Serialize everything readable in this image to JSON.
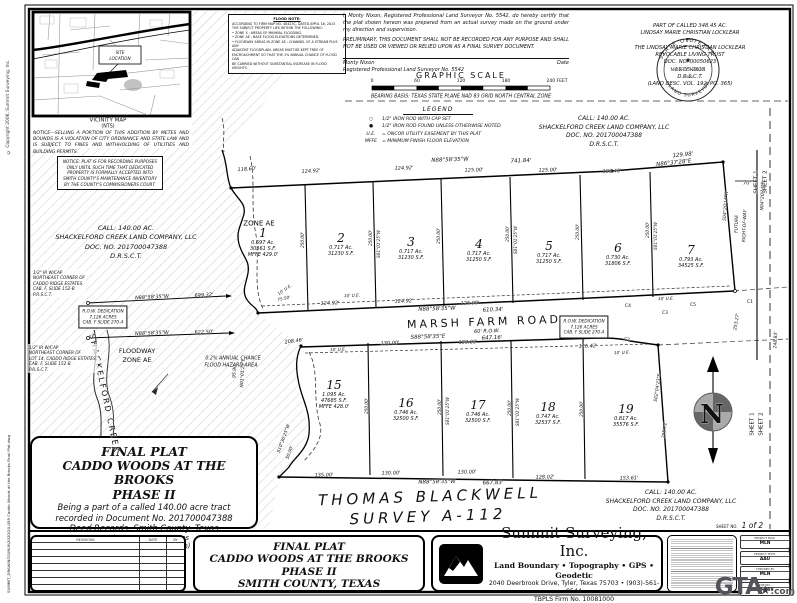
{
  "edge": {
    "copyright": "© Copyright 2006, Summit Surveying, Inc.",
    "file": "SUMMIT_DRAWINGS\\MLN\\2020\\20-059 Caddo Woods at the Brooks Final Plat.dwg"
  },
  "notices": {
    "selling": "NOTICE—SELLING A PORTION OF THIS ADDITION BY METES AND BOUNDS IS A VIOLATION OF CITY ORDINANCE AND STATE LAW AND IS SUBJECT TO FINES AND WITHHOLDING OF UTILITIES AND BUILDING PERMITS.",
    "recording": "NOTICE: PLAT IS FOR RECORDING PURPOSES ONLY UNTIL SUCH TIME THAT DEDICATED PROPERTY IS FORMALLY ACCEPTED INTO SMITH COUNTY'S MAINTENANCE INVENTORY BY THE COUNTY'S COMMISSIONERS COURT."
  },
  "flood_note": {
    "title": "FLOOD NOTE:",
    "lines": [
      "ACCORDING TO FIRM MAP NO. 48423C, DATED APRIL 16, 2013",
      "THE SUBJECT PROPERTY LIES WITHIN THE FOLLOWING:",
      "•  ZONE X : AREAS OF MINIMAL FLOODING.",
      "•  ZONE AE : BASE FLOOD ELEVATIONS DETERMINED.",
      "•  FLOODWAY AREAS IN ZONE AE : CHANNEL OF A STREAM PLUS ANY",
      "ADJACENT FLOODPLAIN. AREAS MUST BE KEPT FREE OF",
      "ENCROACHMENT SO THAT THE 1% ANNUAL CHANCE OF FLOOD CAN",
      "BE CARRIED WITHOUT SUBSTANTIAL INCREASE IN FLOOD HEIGHTS."
    ]
  },
  "cert": {
    "para": "I, Monty Nixon, Registered Professional Land Surveyor No. 5542, do hereby certify that the plat shown hereon was prepared from an actual survey made on the ground under my direction and supervision.",
    "prelim": "PRELIMINARY, THIS DOCUMENT SHALL NOT BE RECORDED FOR ANY PURPOSE AND SHALL NOT BE USED OR VIEWED OR RELIED UPON AS A FINAL SURVEY DOCUMENT.",
    "sig_name": "Monty Nixon",
    "sig_date": "Date",
    "sig_title": "Registered Professional Land Surveyor No. 5542"
  },
  "seal": {
    "arc_top": "STATE OF TEXAS",
    "arc_bottom": "LAND SURVEYOR",
    "star": "★",
    "name": "MONTY NIXON",
    "number": "5542"
  },
  "owner": {
    "lines": [
      "PART OF CALLED 348.45 AC.",
      "LINDSAY MARIE CHRISTIAN LOCKLEAR",
      "TO",
      "THE LINDSAY MARIE CHRISTIAN LOCKLEAR",
      "REVOCABLE LIVING TRUST",
      "DOC. NO. 00050623",
      "11-05-2013",
      "D.R.S.C.T.",
      "(LAND DESC. VOL. 192, PG. 365)"
    ]
  },
  "legend": {
    "title": "LEGEND",
    "items": [
      {
        "sym": "○",
        "text": "1/2\" IRON ROD WITH CAP SET"
      },
      {
        "sym": "●",
        "text": "1/2\" IRON ROD FOUND UNLESS OTHERWISE NOTED"
      },
      {
        "sym": "U.E.",
        "text": "= ONCOR UTILITY EASEMENT BY THIS PLAT"
      },
      {
        "sym": "MFFE",
        "text": "= MINIMUM FINISH FLOOR ELEVATION"
      }
    ]
  },
  "call": {
    "lines": [
      "CALL: 140.00 AC.",
      "SHACKELFORD CREEK LAND COMPANY, LLC",
      "DOC. NO. 201700047388",
      "D.R.S.C.T."
    ]
  },
  "plat_title": {
    "l1": "FINAL PLAT",
    "l2": "CADDO WOODS AT THE BROOKS",
    "l3": "PHASE II",
    "d1": "Being a part of a called 140.00 acre tract",
    "d2": "recorded in Document No. 201700047388",
    "d3": "Deed Records, Smith County, Texas",
    "total": "Total: 19 Lots  14.239 Acres",
    "row_note": "(No right-of-way dedication)"
  },
  "revisions": {
    "headers": [
      "REVISIONS",
      "DATE",
      "BY"
    ],
    "empty_rows": 7
  },
  "titleblock": {
    "l1": "FINAL PLAT",
    "l2": "CADDO WOODS AT THE BROOKS",
    "l3": "PHASE II",
    "l4": "SMITH COUNTY, TEXAS"
  },
  "firm": {
    "name": "Summit Surveying, Inc.",
    "services": "Land Boundary • Topography • GPS • Geodetic",
    "address": "2040 Deerbrook Drive, Tyler, Texas 75703 • (903)-561-9544",
    "firm_no": "TBPLS Firm No. 10081000"
  },
  "project": {
    "sheet_label": "SHEET NO.",
    "sheet_value": "1  of  2",
    "items": [
      {
        "label": "PROJECT MGR.",
        "value": "MLN"
      },
      {
        "label": "PROJECT TECH.",
        "value": "AAU"
      },
      {
        "label": "CHECKED BY",
        "value": "MLN"
      },
      {
        "label": "JOB NO.",
        "value": "20-059"
      }
    ]
  },
  "watermark": {
    "main": "GTA",
    "star": "★",
    "tld": ".com"
  },
  "plat": {
    "lots": [
      {
        "n": "1",
        "a": "0.697 Ac.",
        "s": "30361 S.F.",
        "m": "MFFE 429.0'",
        "x": 263,
        "y": 226
      },
      {
        "n": "2",
        "a": "0.717 Ac.",
        "s": "31230 S.F.",
        "x": 341,
        "y": 231
      },
      {
        "n": "3",
        "a": "0.717 Ac.",
        "s": "31230 S.F.",
        "x": 411,
        "y": 235
      },
      {
        "n": "4",
        "a": "0.717 Ac.",
        "s": "31250 S.F.",
        "x": 479,
        "y": 237
      },
      {
        "n": "5",
        "a": "0.717 Ac.",
        "s": "31250 S.F.",
        "x": 549,
        "y": 239
      },
      {
        "n": "6",
        "a": "0.730 Ac.",
        "s": "31806 S.F.",
        "x": 618,
        "y": 241
      },
      {
        "n": "7",
        "a": "0.793 Ac.",
        "s": "34525 S.F.",
        "x": 691,
        "y": 243
      },
      {
        "n": "15",
        "a": "1.095 Ac.",
        "s": "47685 S.F.",
        "m": "MFFE 428.0'",
        "x": 334,
        "y": 378
      },
      {
        "n": "16",
        "a": "0.746 Ac.",
        "s": "32500 S.F.",
        "x": 406,
        "y": 396
      },
      {
        "n": "17",
        "a": "0.746 Ac.",
        "s": "32500 S.F.",
        "x": 478,
        "y": 398
      },
      {
        "n": "18",
        "a": "0.747 Ac.",
        "s": "32537 S.F.",
        "x": 548,
        "y": 400
      },
      {
        "n": "19",
        "a": "0.817 Ac.",
        "s": "35576 S.F.",
        "x": 626,
        "y": 402
      }
    ],
    "notes": [
      {
        "x": 32,
        "y": 269,
        "lines": [
          "1/2\" IR W/CAP",
          "NORTHEAST CORNER OF",
          "CADDO RIDGE ESTATES",
          "CAB. F, SLIDE 152-B",
          "P.R.S.C.T."
        ]
      },
      {
        "x": 28,
        "y": 344,
        "lines": [
          "1/2\" IR W/CAP",
          "NORTHEAST CORNER OF",
          "LOT 14, CADDO RIDGE ESTATES,",
          "CAB. F, SLIDE 152-B",
          "P.R.S.C.T."
        ]
      }
    ],
    "boxes": [
      {
        "x": 103,
        "y": 317,
        "lines": [
          "R.O.W. DEDICATION",
          "7.126 ACRES",
          "CAB. F SLIDE 270-A"
        ]
      },
      {
        "x": 584,
        "y": 327,
        "lines": [
          "R.O.W. DEDICATION",
          "7.126 ACRES",
          "CAB. F SLIDE 270-A"
        ]
      }
    ],
    "labels": [
      [
        "118.60'",
        247,
        170,
        -4,
        5
      ],
      [
        "124.92'",
        311,
        172,
        -3,
        5
      ],
      [
        "124.92'",
        404,
        169,
        -2,
        5
      ],
      [
        "N88°58'35\"W",
        450,
        161,
        -2,
        5.5
      ],
      [
        "741.84'",
        521,
        162,
        -2,
        5.5
      ],
      [
        "125.00'",
        474,
        171,
        -2,
        5
      ],
      [
        "125.00'",
        548,
        171,
        -2,
        5
      ],
      [
        "123.40'",
        612,
        172,
        -2,
        5
      ],
      [
        "129.98'",
        683,
        156,
        -6,
        5.5
      ],
      [
        "N86°37'28\"E",
        674,
        164,
        -6,
        5.5
      ],
      [
        "250.00'",
        303,
        240,
        -90,
        4.2
      ],
      [
        "250.00'",
        371,
        238,
        -90,
        4.2
      ],
      [
        "250.00'",
        439,
        236,
        -90,
        4.2
      ],
      [
        "250.00'",
        508,
        234,
        -90,
        4.2
      ],
      [
        "250.00'",
        578,
        232,
        -90,
        4.2
      ],
      [
        "250.00'",
        648,
        230,
        -90,
        4.2
      ],
      [
        "S01°01'25\"W",
        379,
        244,
        -90,
        4.2
      ],
      [
        "S01°01'25\"W",
        516,
        240,
        -90,
        4.2
      ],
      [
        "S01°01'25\"W",
        656,
        236,
        -90,
        4.2
      ],
      [
        "10' U.E.",
        352,
        296,
        -2,
        4.2
      ],
      [
        "10' U.E.",
        666,
        299,
        -2,
        4.2
      ],
      [
        "10' U.E.",
        338,
        350,
        -2,
        4.2
      ],
      [
        "10' U.E.",
        622,
        353,
        -2,
        4.2
      ],
      [
        "10' U.E.",
        285,
        290,
        -35,
        4.2
      ],
      [
        "75.50'",
        284,
        299,
        -12,
        4.2
      ],
      [
        "124.92'",
        330,
        304,
        -2,
        5
      ],
      [
        "124.92'",
        404,
        302,
        -2,
        5
      ],
      [
        "125.00'",
        470,
        304,
        -2,
        5
      ],
      [
        "N88°58'35\"W",
        437,
        310,
        -2,
        5.5
      ],
      [
        "610.34'",
        493,
        311,
        -2,
        5.5
      ],
      [
        "MARSH FARM ROAD",
        484,
        322,
        -2,
        11,
        "road"
      ],
      [
        "60' R.O.W.",
        487,
        332,
        -2,
        5
      ],
      [
        "S88°58'35\"E",
        428,
        338,
        -2,
        5.5
      ],
      [
        "647.16'",
        492,
        339,
        -2,
        5.5
      ],
      [
        "208.46'",
        294,
        342,
        -7,
        5
      ],
      [
        "130.00'",
        390,
        344,
        -2,
        5
      ],
      [
        "130.00'",
        468,
        343,
        -2,
        5
      ],
      [
        "126.42'",
        588,
        347,
        -2,
        5
      ],
      [
        "C1",
        750,
        303,
        0,
        4.5,
        "sp"
      ],
      [
        "C2",
        627,
        341,
        0,
        4.5,
        "sp"
      ],
      [
        "C3",
        665,
        314,
        0,
        4.5,
        "sp"
      ],
      [
        "C4",
        628,
        307,
        0,
        4.5,
        "sp"
      ],
      [
        "C5",
        693,
        306,
        0,
        4.5,
        "sp"
      ],
      [
        "250.00'",
        367,
        406,
        -90,
        4.2
      ],
      [
        "250.00'",
        440,
        407,
        -90,
        4.2
      ],
      [
        "250.00'",
        510,
        408,
        -90,
        4.2
      ],
      [
        "250.00'",
        582,
        409,
        -90,
        4.2
      ],
      [
        "S01°01'25\"W",
        448,
        411,
        -90,
        4.2
      ],
      [
        "S01°01'25\"W",
        518,
        412,
        -90,
        4.2
      ],
      [
        "135.00'",
        324,
        476,
        -1,
        5
      ],
      [
        "130.00'",
        391,
        474,
        -1,
        5
      ],
      [
        "130.00'",
        467,
        473,
        -1,
        5
      ],
      [
        "N88°58'35\"W",
        437,
        483,
        -1,
        5.5
      ],
      [
        "667.83'",
        493,
        484,
        -1,
        5.5
      ],
      [
        "128.02'",
        545,
        478,
        -1,
        5
      ],
      [
        "153.61'",
        629,
        479,
        -1,
        5
      ],
      [
        "255.72'",
        666,
        430,
        -82,
        4.5
      ],
      [
        "S02°04'23\"E",
        659,
        388,
        -82,
        4.5
      ],
      [
        "50.00'",
        291,
        453,
        -70,
        4.5
      ],
      [
        "S10°36'25\"W",
        285,
        439,
        -70,
        4.5
      ],
      [
        "95.90'",
        236,
        371,
        -87,
        4.5
      ],
      [
        "N01°01'25\"E",
        244,
        373,
        -87,
        4.5
      ],
      [
        "N88°58'35\"W",
        152,
        298,
        -3,
        5
      ],
      [
        "699.32'",
        204,
        296,
        -3,
        5
      ],
      [
        "N88°58'35\"W",
        152,
        334,
        -2,
        5
      ],
      [
        "622.50'",
        204,
        333,
        -2,
        5
      ],
      [
        "ZONE AE",
        259,
        224,
        0,
        7,
        "sp"
      ],
      [
        "FLOODWAY",
        137,
        351,
        0,
        6.5,
        "sp"
      ],
      [
        "ZONE AE",
        137,
        360,
        0,
        6.5,
        "sp"
      ],
      [
        "SHACKELFORD CREEK",
        104,
        394,
        78,
        8,
        "crk"
      ],
      [
        "0.2% ANNUAL CHANCE",
        233,
        360,
        0,
        4.8
      ],
      [
        "FLOOD HAZARD AREA",
        231,
        367,
        0,
        4.8
      ],
      [
        "70'",
        747,
        184,
        0,
        5
      ],
      [
        "FUTURE",
        738,
        224,
        -88,
        4.5
      ],
      [
        "RIGHT-OF-WAY",
        746,
        226,
        -88,
        4.5
      ],
      [
        "S04°20'14\"W",
        727,
        206,
        -86,
        4.5
      ],
      [
        "253.27'",
        738,
        322,
        -80,
        4.5
      ],
      [
        "N04°20'14\"E",
        764,
        196,
        -88,
        4.5
      ],
      [
        "248.83'",
        777,
        340,
        -87,
        4.5
      ],
      [
        "SHEET 1",
        753,
        424,
        -90,
        5.5,
        "sp"
      ],
      [
        "SHEET 2",
        762,
        424,
        -90,
        5.5,
        "sp"
      ],
      [
        "SHEET 1",
        757,
        182,
        -90,
        5.5,
        "sp"
      ],
      [
        "SHEET 2",
        766,
        182,
        -90,
        5.5,
        "sp"
      ],
      [
        "THOMAS BLACKWELL",
        430,
        497,
        -2,
        15,
        "surv"
      ],
      [
        "SURVEY A-112",
        428,
        517,
        -2,
        15,
        "surv"
      ],
      [
        "SITE",
        120,
        53,
        0,
        4.2
      ],
      [
        "LOCATION",
        120,
        59,
        0,
        4.2
      ],
      [
        "VICINITY MAP",
        108,
        121,
        0,
        5.5,
        "sp"
      ],
      [
        "(NTS)",
        108,
        128,
        0,
        4.8,
        "sp"
      ],
      [
        "GRAPHIC SCALE",
        461,
        76,
        0,
        8,
        "gs"
      ],
      [
        "0",
        372,
        82,
        0,
        4.5,
        "sp"
      ],
      [
        "60",
        417,
        82,
        0,
        4.5,
        "sp"
      ],
      [
        "120",
        461,
        82,
        0,
        4.5,
        "sp"
      ],
      [
        "180",
        506,
        82,
        0,
        4.5,
        "sp"
      ],
      [
        "240 FEET",
        557,
        82,
        0,
        4.5,
        "sp"
      ],
      [
        "BEARING BASIS: TEXAS STATE PLANE NAD 83 GRID NORTH CENTRAL ZONE",
        461,
        98,
        0,
        4.8
      ],
      [
        "★",
        688,
        61,
        0,
        7,
        "sp"
      ],
      [
        "MONTY NIXON",
        688,
        71,
        0,
        4.4,
        "sealt"
      ],
      [
        "5542",
        688,
        77,
        0,
        4,
        "sealt"
      ],
      [
        "N",
        712,
        415,
        0,
        26,
        "cmp"
      ]
    ]
  }
}
